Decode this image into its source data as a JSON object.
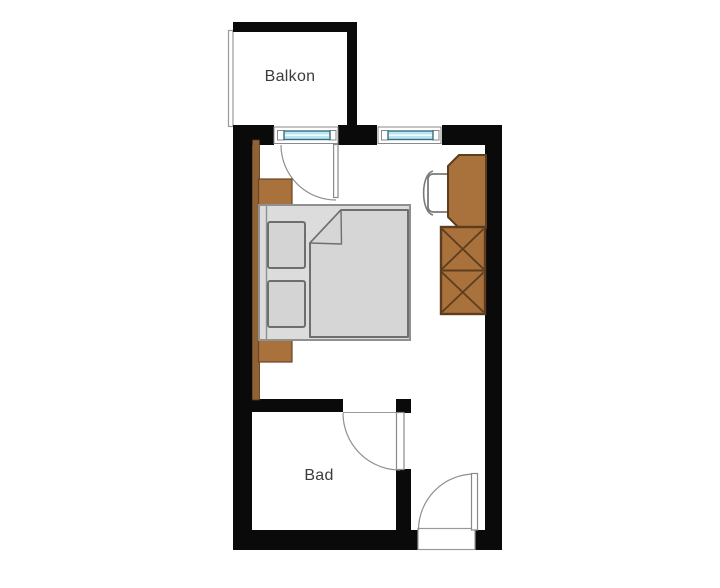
{
  "page": {
    "background_color": "#ffffff",
    "width": 720,
    "height": 588
  },
  "floorplan": {
    "labels": {
      "balcony": "Balkon",
      "bathroom": "Bad"
    },
    "rooms": [
      {
        "name": "balcony",
        "label": "Balkon"
      },
      {
        "name": "bedroom",
        "label": ""
      },
      {
        "name": "bathroom",
        "label": "Bad"
      }
    ],
    "features": {
      "window_count": 2,
      "doors": [
        "balcony-door",
        "bathroom-door",
        "entrance-door"
      ],
      "furniture": [
        "double-bed",
        "pillow-top",
        "pillow-bottom",
        "blanket",
        "nightstand-upper",
        "nightstand-lower",
        "wall-trim",
        "desk",
        "chair",
        "wardrobe"
      ]
    },
    "colors": {
      "wall": "#0a0a0a",
      "wood": "#a9713c",
      "wood_dark": "#5e3d1c",
      "wood_trim": "#8f6134",
      "bed_fill": "#dcdcdc",
      "bed_outline": "#909090",
      "pillow_fill": "#d4d4d4",
      "pillow_outline": "#6e6e6e",
      "window_glass": "#b7e6f4",
      "window_glass_outline": "#3f6d7d",
      "door_arc": "#909090",
      "label_text": "#3b3b3b",
      "background": "#ffffff"
    }
  }
}
